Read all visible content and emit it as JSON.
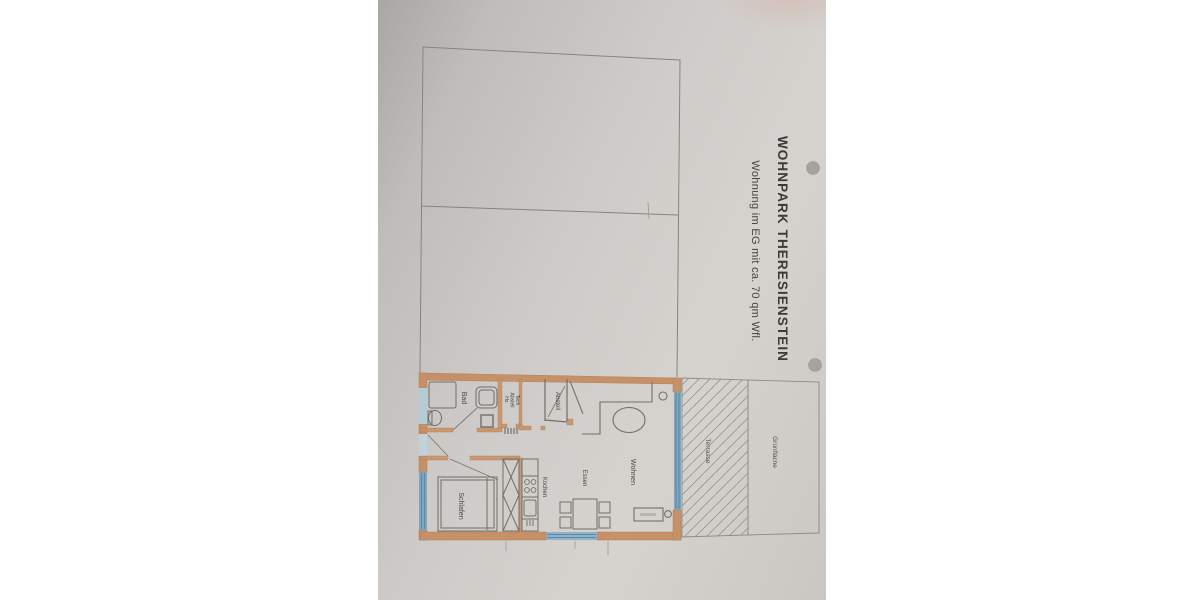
{
  "titles": {
    "line1": "WOHNPARK THERESIENSTEIN",
    "line2": "Wohnung im  EG mit ca. 70 qm Wfl."
  },
  "rooms": {
    "bad": "Bad",
    "hz1": "Hz.",
    "hz2": "Abstell",
    "hz3": "Tech",
    "abstell": "Abstell",
    "wohnen": "Wohnen",
    "essen": "Essen",
    "kochen": "Kochen",
    "schlafen": "Schlafen",
    "terrasse": "Terrasse",
    "gruenflaeche": "Grünfläche"
  },
  "colors": {
    "paper": "#cfccc9",
    "wall_orange": "#c58b5f",
    "window_blue_strong": "#7da6c0",
    "window_blue_pale": "#b6cbd8",
    "pencil_line": "#82827c",
    "furniture_line": "#6f6f68",
    "text_dark": "#3e3e3c",
    "hole_punch": "#a4a39d"
  }
}
